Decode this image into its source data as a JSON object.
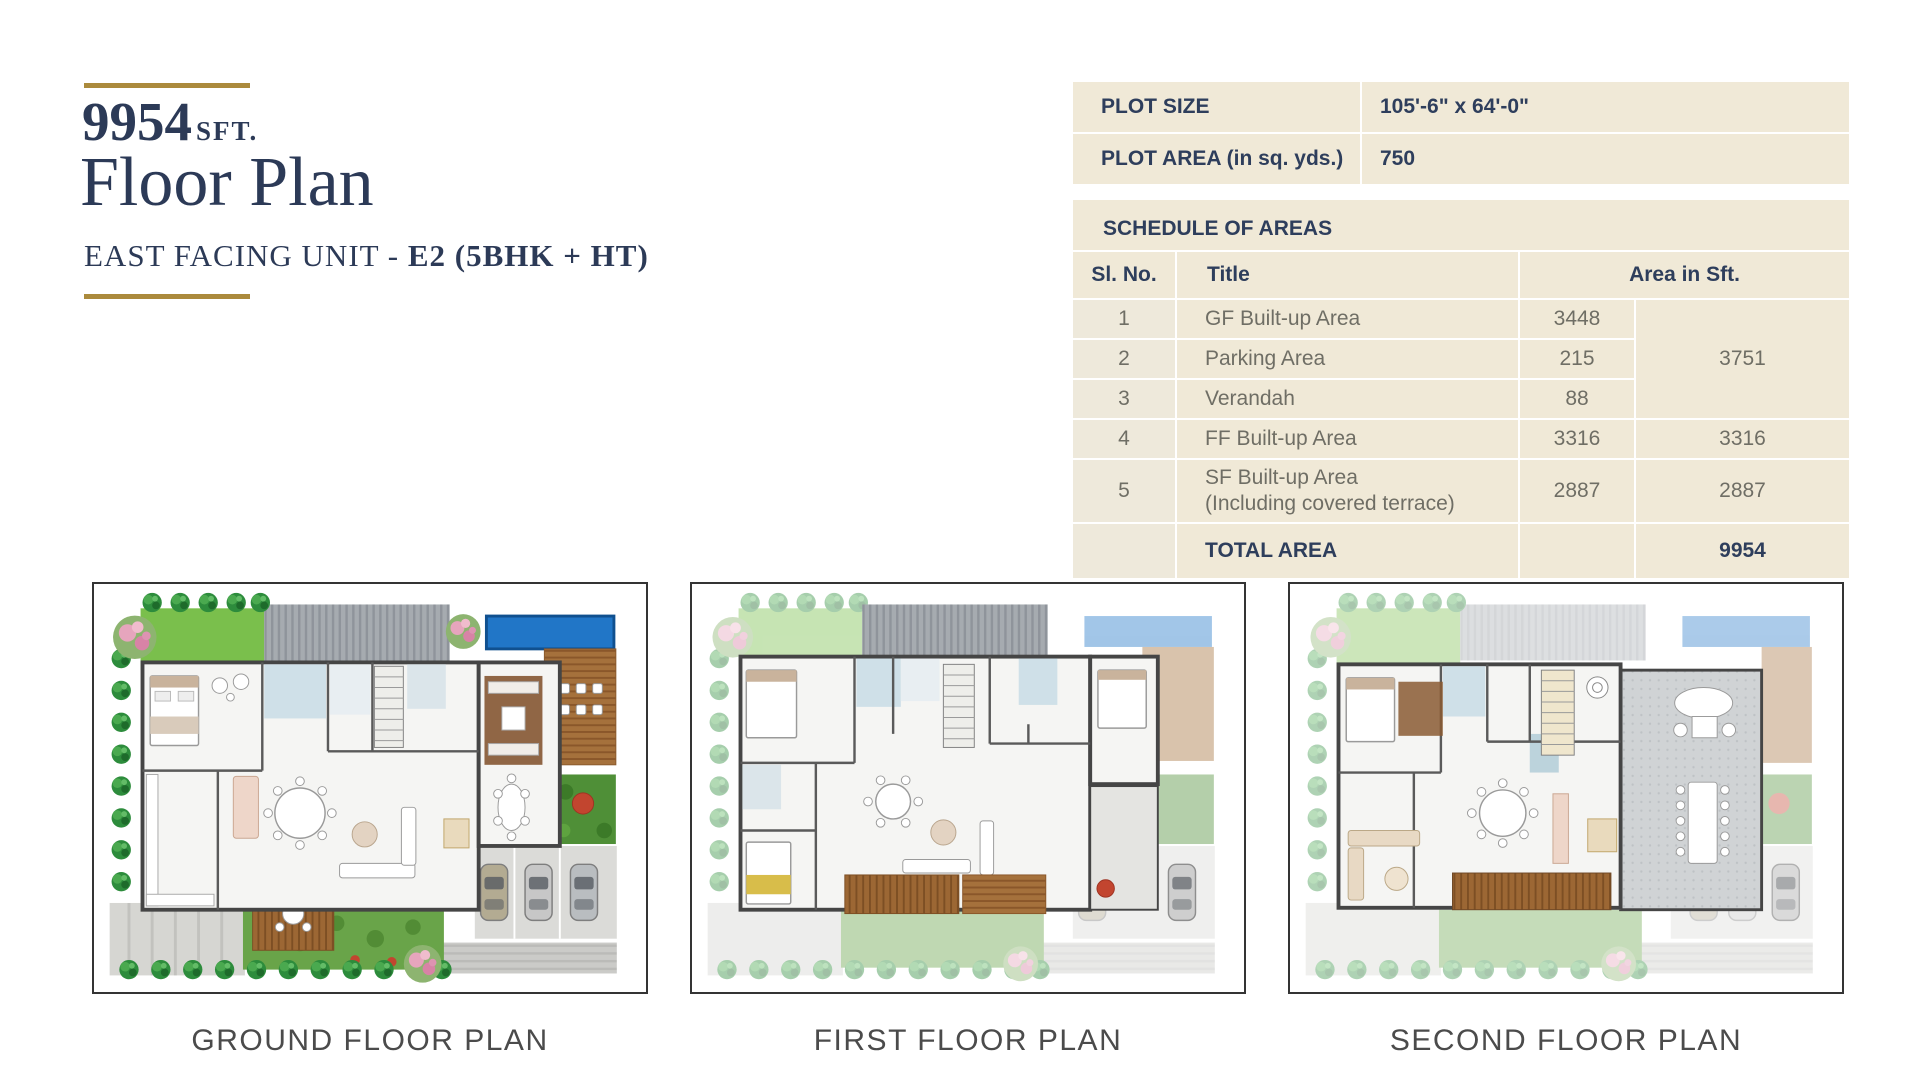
{
  "header": {
    "area_value": "9954",
    "area_unit": "SFT.",
    "title": "Floor Plan",
    "subtitle_prefix": "EAST FACING UNIT - ",
    "subtitle_em": "E2 (5BHK + HT)"
  },
  "plot_table": {
    "rows": [
      {
        "label": "PLOT SIZE",
        "value": "105'-6\" x 64'-0\""
      },
      {
        "label": "PLOT AREA (in sq. yds.)",
        "value": "750"
      }
    ]
  },
  "schedule": {
    "caption": "SCHEDULE OF AREAS",
    "columns": {
      "sl_no": "Sl. No.",
      "title": "Title",
      "area": "Area in Sft."
    },
    "rows": [
      {
        "sl_no": "1",
        "title": "GF Built-up Area",
        "area": "3448"
      },
      {
        "sl_no": "2",
        "title": "Parking Area",
        "area": "215"
      },
      {
        "sl_no": "3",
        "title": "Verandah",
        "area": "88"
      },
      {
        "sl_no": "4",
        "title": "FF Built-up Area",
        "area": "3316",
        "subtotal": "3316"
      },
      {
        "sl_no": "5",
        "title": "SF Built-up Area",
        "title_line2": "(Including covered terrace)",
        "area": "2887",
        "subtotal": "2887"
      }
    ],
    "merged_subtotal": "3751",
    "total_label": "TOTAL AREA",
    "total_value": "9954"
  },
  "plans": [
    {
      "caption": "GROUND FLOOR PLAN"
    },
    {
      "caption": "FIRST FLOOR PLAN"
    },
    {
      "caption": "SECOND FLOOR PLAN"
    }
  ],
  "palette": {
    "accent_gold": "#ab8a3c",
    "navy": "#2e3e5c",
    "table_beige": "#f0e9d7",
    "muted_text": "#6f6e65",
    "caption_gray": "#4b4b4b",
    "pool_blue": "#2176c7",
    "lawn_green": "#7abf4c",
    "deck_wood": "#a5713c"
  }
}
